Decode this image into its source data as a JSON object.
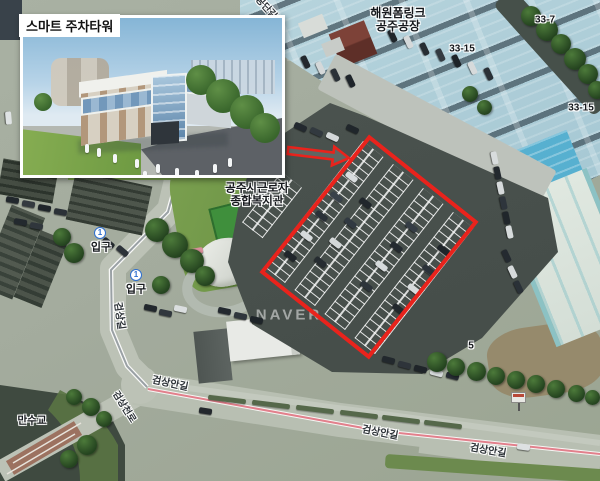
{
  "inset": {
    "label": "스마트 주차타워"
  },
  "map_labels": {
    "factory_line1": "해원폼링크",
    "factory_line2": "공주공장",
    "welfare_line1": "공주시근로자",
    "welfare_line2": "종합복지관",
    "parcel_33_15_a": "33-15",
    "parcel_33_7": "33-7",
    "parcel_33_15_b": "33-15",
    "entrance_num": "1",
    "entrance_1": "입구",
    "entrance_2": "입구",
    "road_geomsang": "검상길",
    "road_geomsangan_1": "검상안길",
    "road_geomsangan_2": "검상안길",
    "road_geomsangan_3": "검상안길",
    "road_gongdan": "공단길",
    "road_bridge_side": "검상천로",
    "bridge_name": "만수교",
    "lot_number_5": "5",
    "watermark": "NAVER"
  },
  "annotation": {
    "accent_color": "#e9231c",
    "entrance_marker_color": "#2e6fd0"
  }
}
